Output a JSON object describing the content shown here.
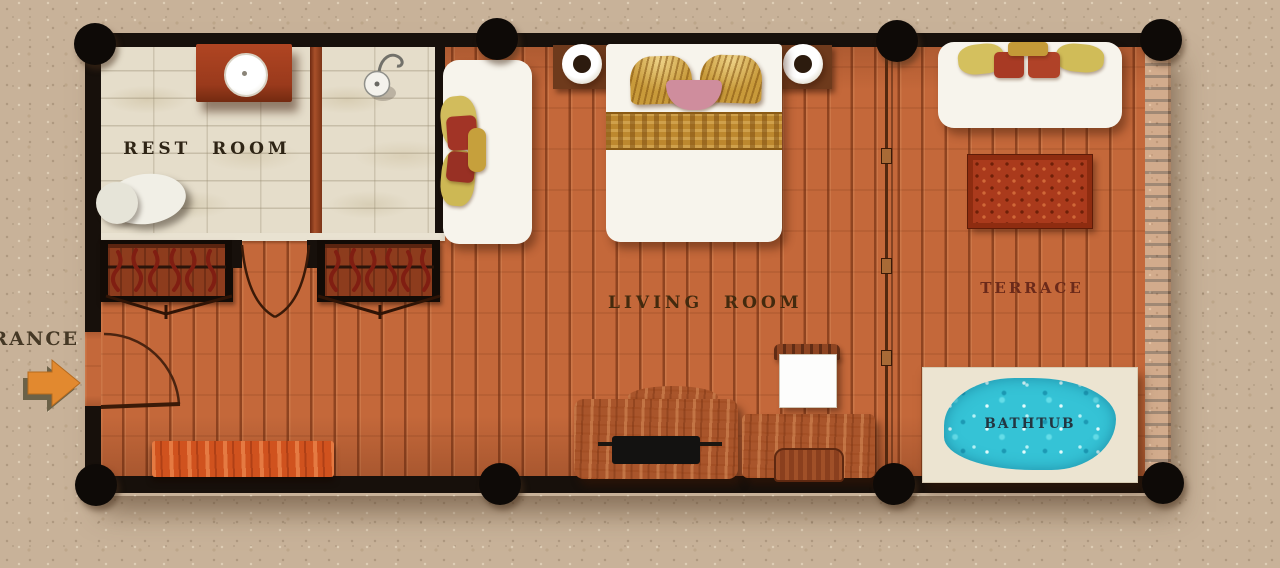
{
  "plan": {
    "title": "villa-floor-plan",
    "labels": {
      "rest_room": "REST ROOM",
      "living_room": "LIVING ROOM",
      "terrace": "TERRACE",
      "bathtub": "BATHTUB",
      "entrance": "ENTRANCE"
    },
    "rooms": [
      "REST ROOM",
      "LIVING ROOM",
      "TERRACE"
    ],
    "features": [
      "vanity-with-round-sink",
      "toilet",
      "shower-head",
      "two-wardrobes-with-hangers",
      "double-swing-closet-doors",
      "entrance-door-with-swing-arc",
      "entrance-arrow",
      "bench",
      "daybed-with-cushions",
      "double-bed-with-pillows",
      "two-nightstands-with-lamps",
      "tv-console",
      "dressing-desk-with-mirror-and-stool",
      "sliding-door-divider",
      "sun-lounger-with-cushions",
      "carved-rug",
      "bathtub-with-water"
    ],
    "colors": {
      "sand_background": "#c8b299",
      "wall_black": "#17100b",
      "wood_floor": "#c4683a",
      "plank_line": "#7e3a18",
      "tile_floor": "#e5ddca",
      "bench_red": "#d0521e",
      "right_wall_red": "#9c2f14",
      "water_cyan": "#35c3d6",
      "arrow_orange": "#e2892f",
      "gold_textile": "#c89a3a",
      "pink_pillow": "#cf8d9d",
      "label_dark": "#2e2415",
      "terrace_label_color": "#6b2a1a",
      "bathtub_label_color": "#233540"
    }
  }
}
